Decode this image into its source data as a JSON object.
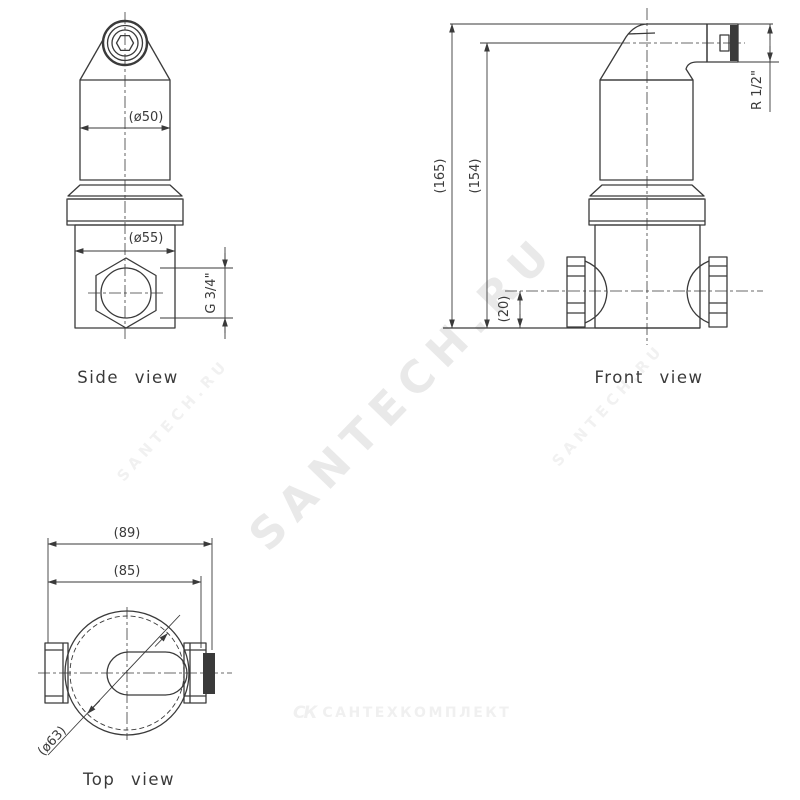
{
  "colors": {
    "background": "#ffffff",
    "line": "#3a3a3a",
    "text": "#3a3a3a",
    "watermark_large": "#e9e9e9",
    "watermark_small": "#f1f1f1",
    "logo": "#f0f0f0"
  },
  "views": {
    "side": {
      "label": "Side view",
      "dim_cap_diameter": "(ø50)",
      "dim_body_diameter": "(ø55)",
      "dim_port_thread": "G 3/4\""
    },
    "front": {
      "label": "Front view",
      "dim_total_height": "(165)",
      "dim_outlet_height": "(154)",
      "dim_port_offset": "(20)",
      "dim_outlet_thread": "R 1/2\""
    },
    "top": {
      "label": "Top view",
      "dim_overall_width": "(89)",
      "dim_body_width": "(85)",
      "dim_flange_diameter": "(ø63)"
    }
  },
  "watermarks": {
    "large": "SANTECH.RU",
    "small_left": "SANTECH.RU",
    "small_right": "SANTECH.RU",
    "logo_icon": "СК",
    "logo_text": "САНТЕХКОМПЛЕКТ"
  }
}
